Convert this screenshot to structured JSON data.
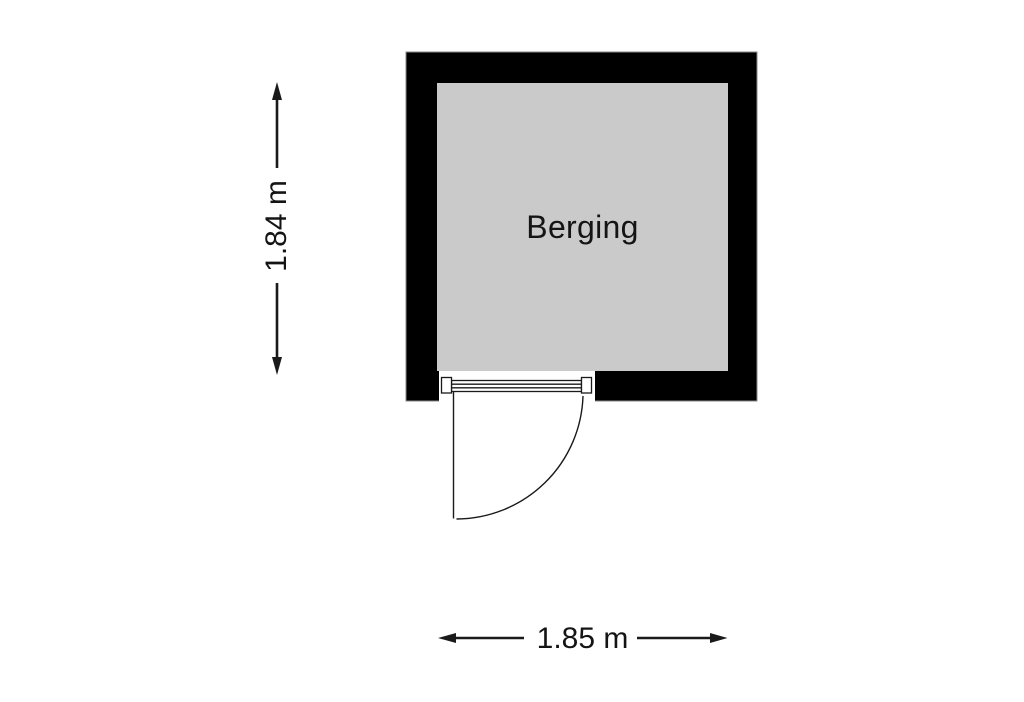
{
  "room": {
    "label": "Berging"
  },
  "dimensions": {
    "vertical": "1.84 m",
    "horizontal": "1.85 m"
  },
  "colors": {
    "wall": "#000000",
    "wall_outline": "#8a8a8a",
    "floor": "#cacaca",
    "ink": "#1a1a1a",
    "background": "#ffffff"
  }
}
